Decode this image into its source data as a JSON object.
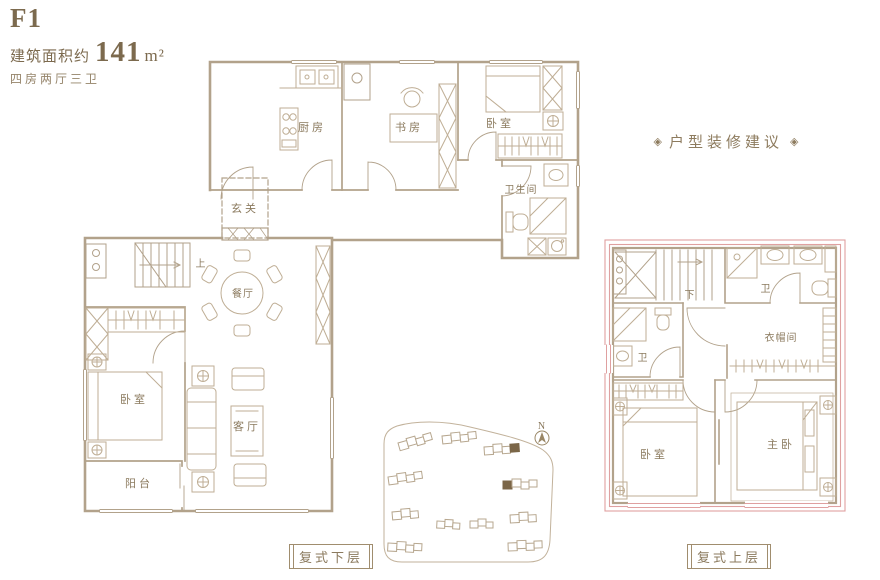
{
  "header": {
    "plan_code": "F1",
    "area_prefix": "建筑面积约",
    "area_value": "141",
    "area_unit": "m²",
    "layout_desc": "四房两厅三卫"
  },
  "suggestion": {
    "ornament_left": "◈",
    "title": "户型装修建议",
    "ornament_right": "◈"
  },
  "compass": {
    "north_label": "N"
  },
  "plans": {
    "lower": {
      "caption": "复式下层",
      "stair_direction": "上",
      "rooms": {
        "kitchen": "厨房",
        "study": "书房",
        "bedroom_top": "卧室",
        "bathroom": "卫生间",
        "entry": "玄关",
        "dining": "餐厅",
        "bedroom_left": "卧室",
        "living": "客厅",
        "balcony": "阳台"
      }
    },
    "upper": {
      "caption": "复式上层",
      "stair_direction": "下",
      "rooms": {
        "bath_top": "卫",
        "bath_left": "卫",
        "cloakroom": "衣帽间",
        "bedroom": "卧室",
        "master_bedroom": "主卧"
      }
    }
  },
  "colors": {
    "wall": "#b2a28b",
    "furniture": "#c0b098",
    "label_text": "#8b7a5e",
    "title_text": "#7c6a4e",
    "upper_outline_red": "#dfa0a0",
    "highlighted_building": "#7b6648"
  }
}
